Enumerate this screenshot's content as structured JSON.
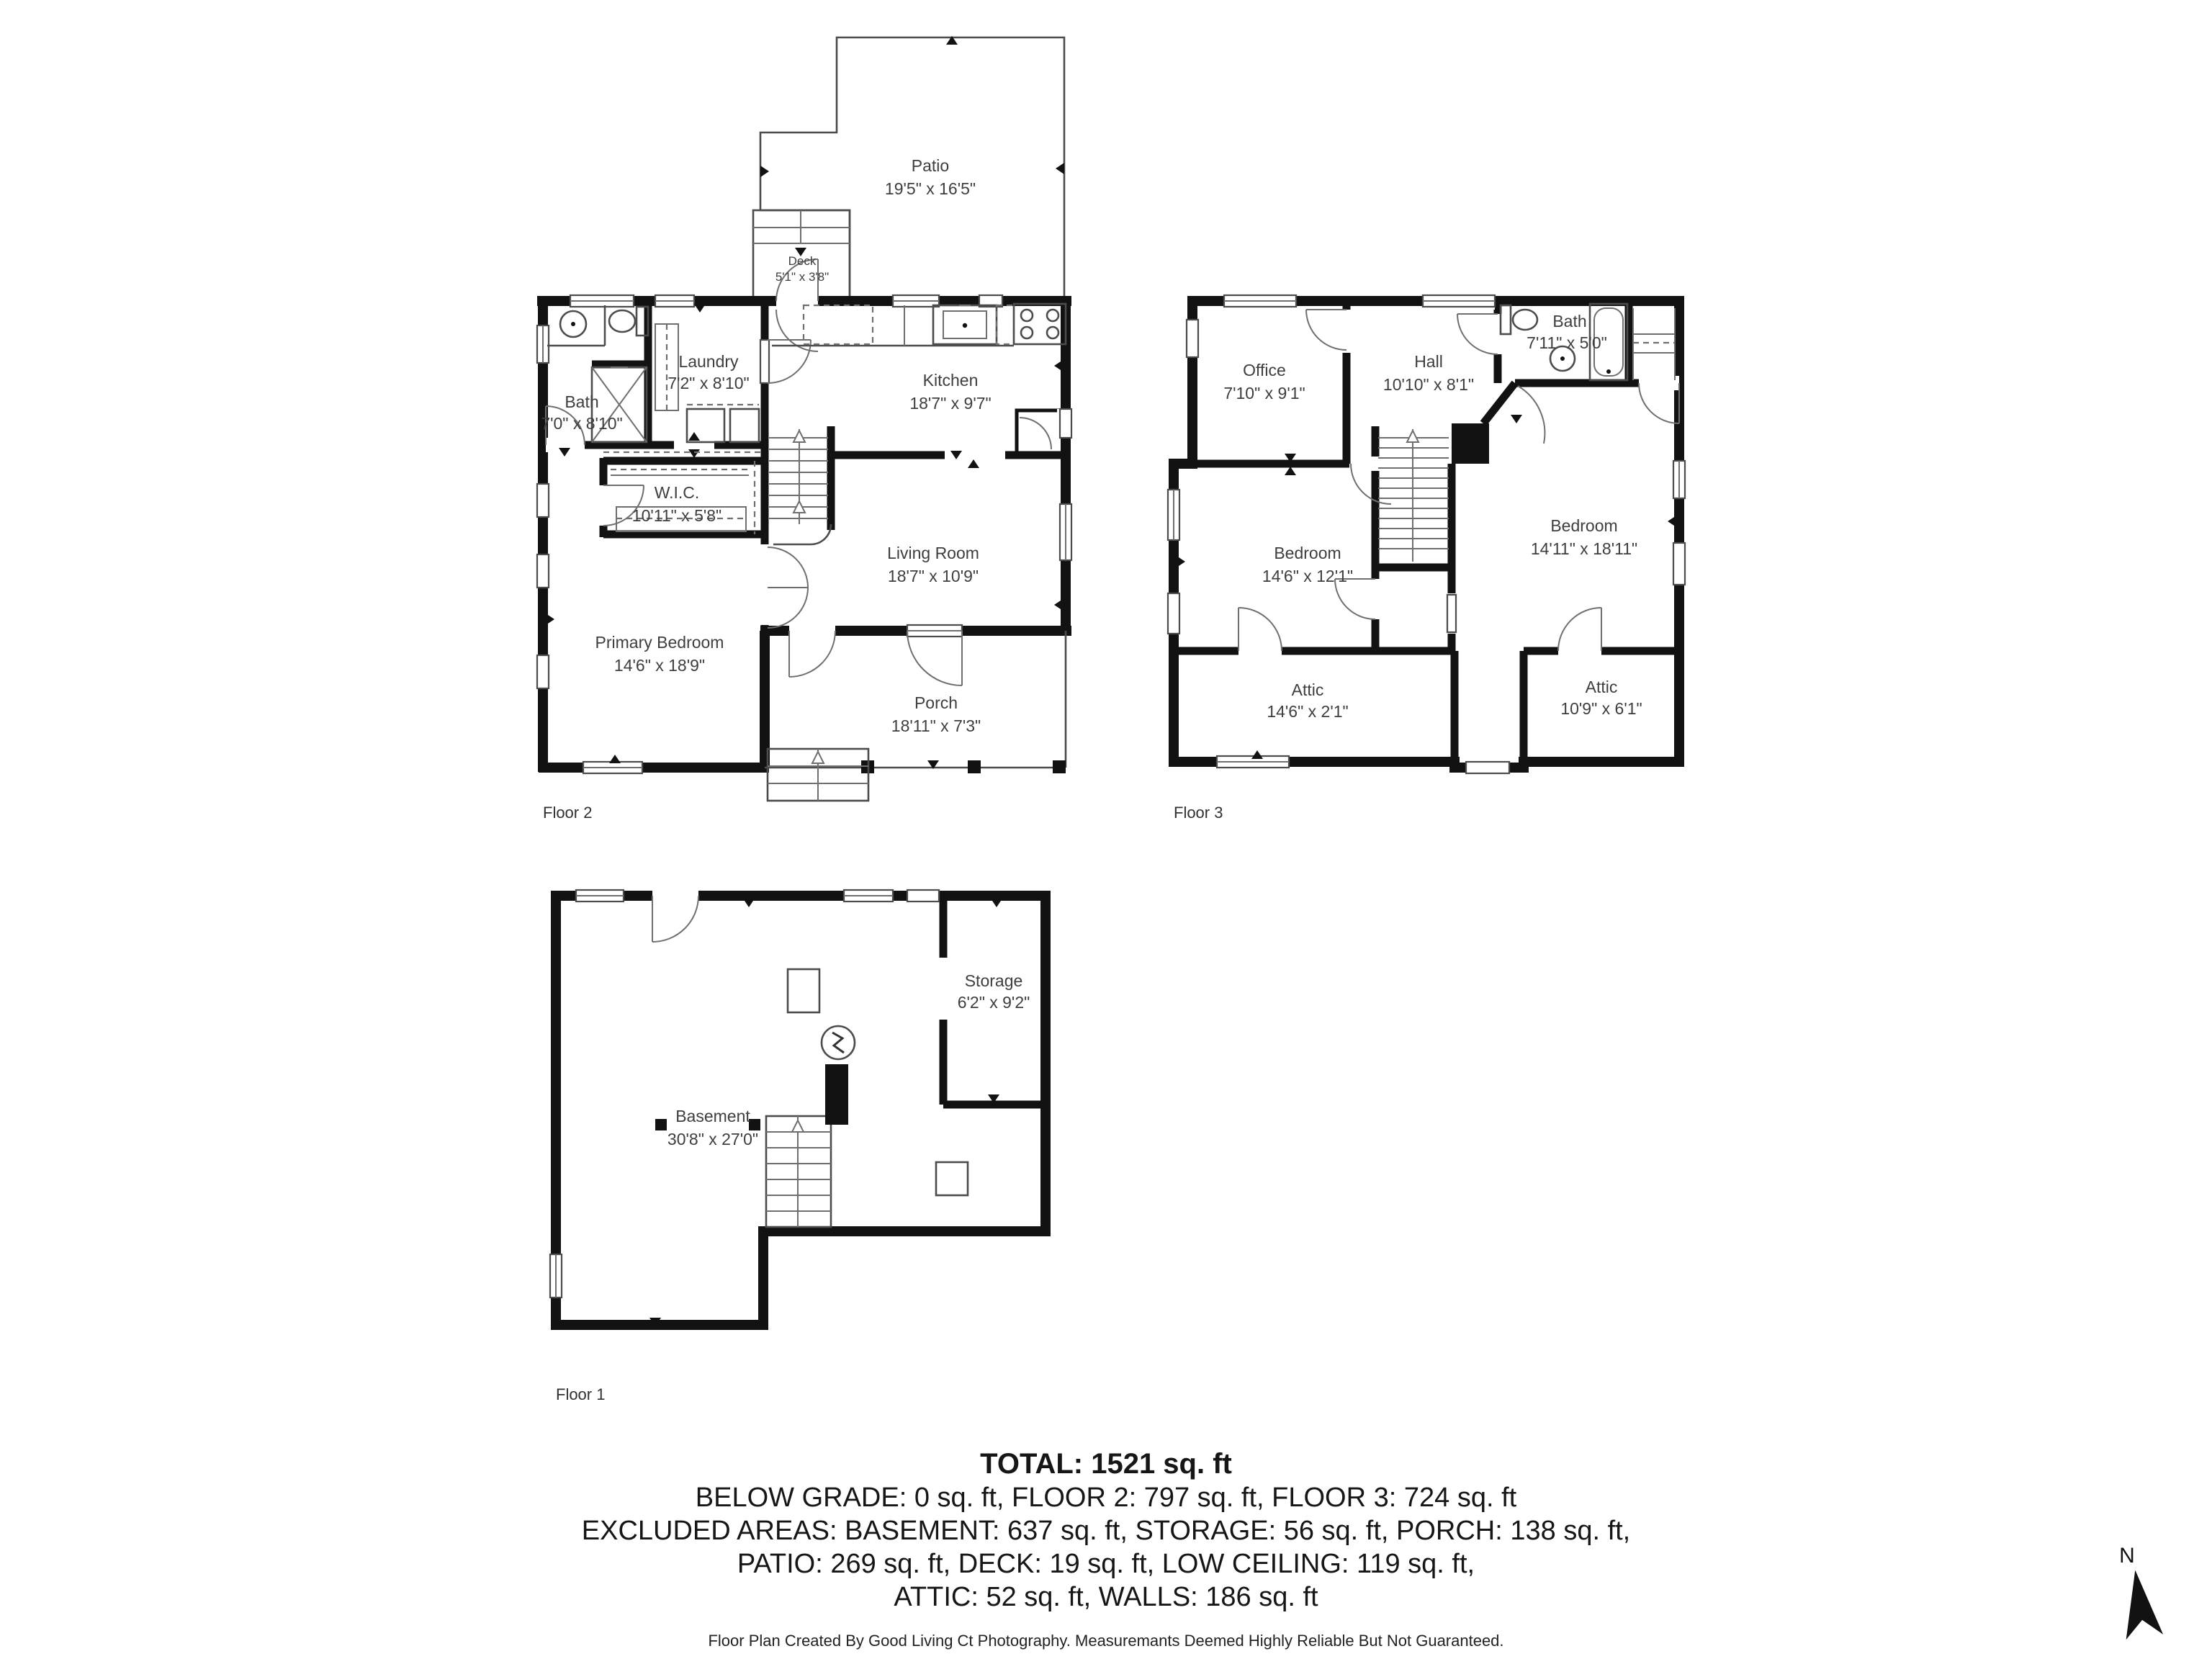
{
  "floors": {
    "floor2": {
      "label": "Floor 2",
      "rooms": {
        "patio": {
          "name": "Patio",
          "dims": "19'5\" x 16'5\""
        },
        "deck": {
          "name": "Deck",
          "dims": "5'1\" x 3'8\""
        },
        "bath": {
          "name": "Bath",
          "dims": "7'0\" x 8'10\""
        },
        "laundry": {
          "name": "Laundry",
          "dims": "7'2\" x 8'10\""
        },
        "kitchen": {
          "name": "Kitchen",
          "dims": "18'7\" x 9'7\""
        },
        "wic": {
          "name": "W.I.C.",
          "dims": "10'11\" x 5'8\""
        },
        "living_room": {
          "name": "Living Room",
          "dims": "18'7\" x 10'9\""
        },
        "primary_bedroom": {
          "name": "Primary Bedroom",
          "dims": "14'6\" x 18'9\""
        },
        "porch": {
          "name": "Porch",
          "dims": "18'11\" x 7'3\""
        }
      }
    },
    "floor3": {
      "label": "Floor 3",
      "rooms": {
        "office": {
          "name": "Office",
          "dims": "7'10\" x 9'1\""
        },
        "hall": {
          "name": "Hall",
          "dims": "10'10\" x 8'1\""
        },
        "bath": {
          "name": "Bath",
          "dims": "7'11\" x 5'0\""
        },
        "bedroom_left": {
          "name": "Bedroom",
          "dims": "14'6\" x 12'1\""
        },
        "bedroom_right": {
          "name": "Bedroom",
          "dims": "14'11\" x 18'11\""
        },
        "attic_left": {
          "name": "Attic",
          "dims": "14'6\" x 2'1\""
        },
        "attic_right": {
          "name": "Attic",
          "dims": "10'9\" x 6'1\""
        }
      }
    },
    "floor1": {
      "label": "Floor 1",
      "rooms": {
        "basement": {
          "name": "Basement",
          "dims": "30'8\" x 27'0\""
        },
        "storage": {
          "name": "Storage",
          "dims": "6'2\" x 9'2\""
        }
      }
    }
  },
  "summary": {
    "total": "TOTAL: 1521 sq. ft",
    "line2": "BELOW GRADE: 0 sq. ft, FLOOR 2: 797 sq. ft, FLOOR 3: 724 sq. ft",
    "line3": "EXCLUDED AREAS: BASEMENT: 637 sq. ft, STORAGE: 56 sq. ft, PORCH: 138 sq. ft,",
    "line4": "PATIO: 269 sq. ft, DECK: 19 sq. ft, LOW CEILING: 119 sq. ft,",
    "line5": "ATTIC: 52 sq. ft, WALLS: 186 sq. ft"
  },
  "footer": "Floor Plan Created By Good Living Ct Photography. Measuremants Deemed Highly Reliable But Not Guaranteed.",
  "compass": {
    "label": "N"
  },
  "colors": {
    "wall": "#121212",
    "line": "#4c4c4c",
    "text": "#3e3e3e"
  }
}
